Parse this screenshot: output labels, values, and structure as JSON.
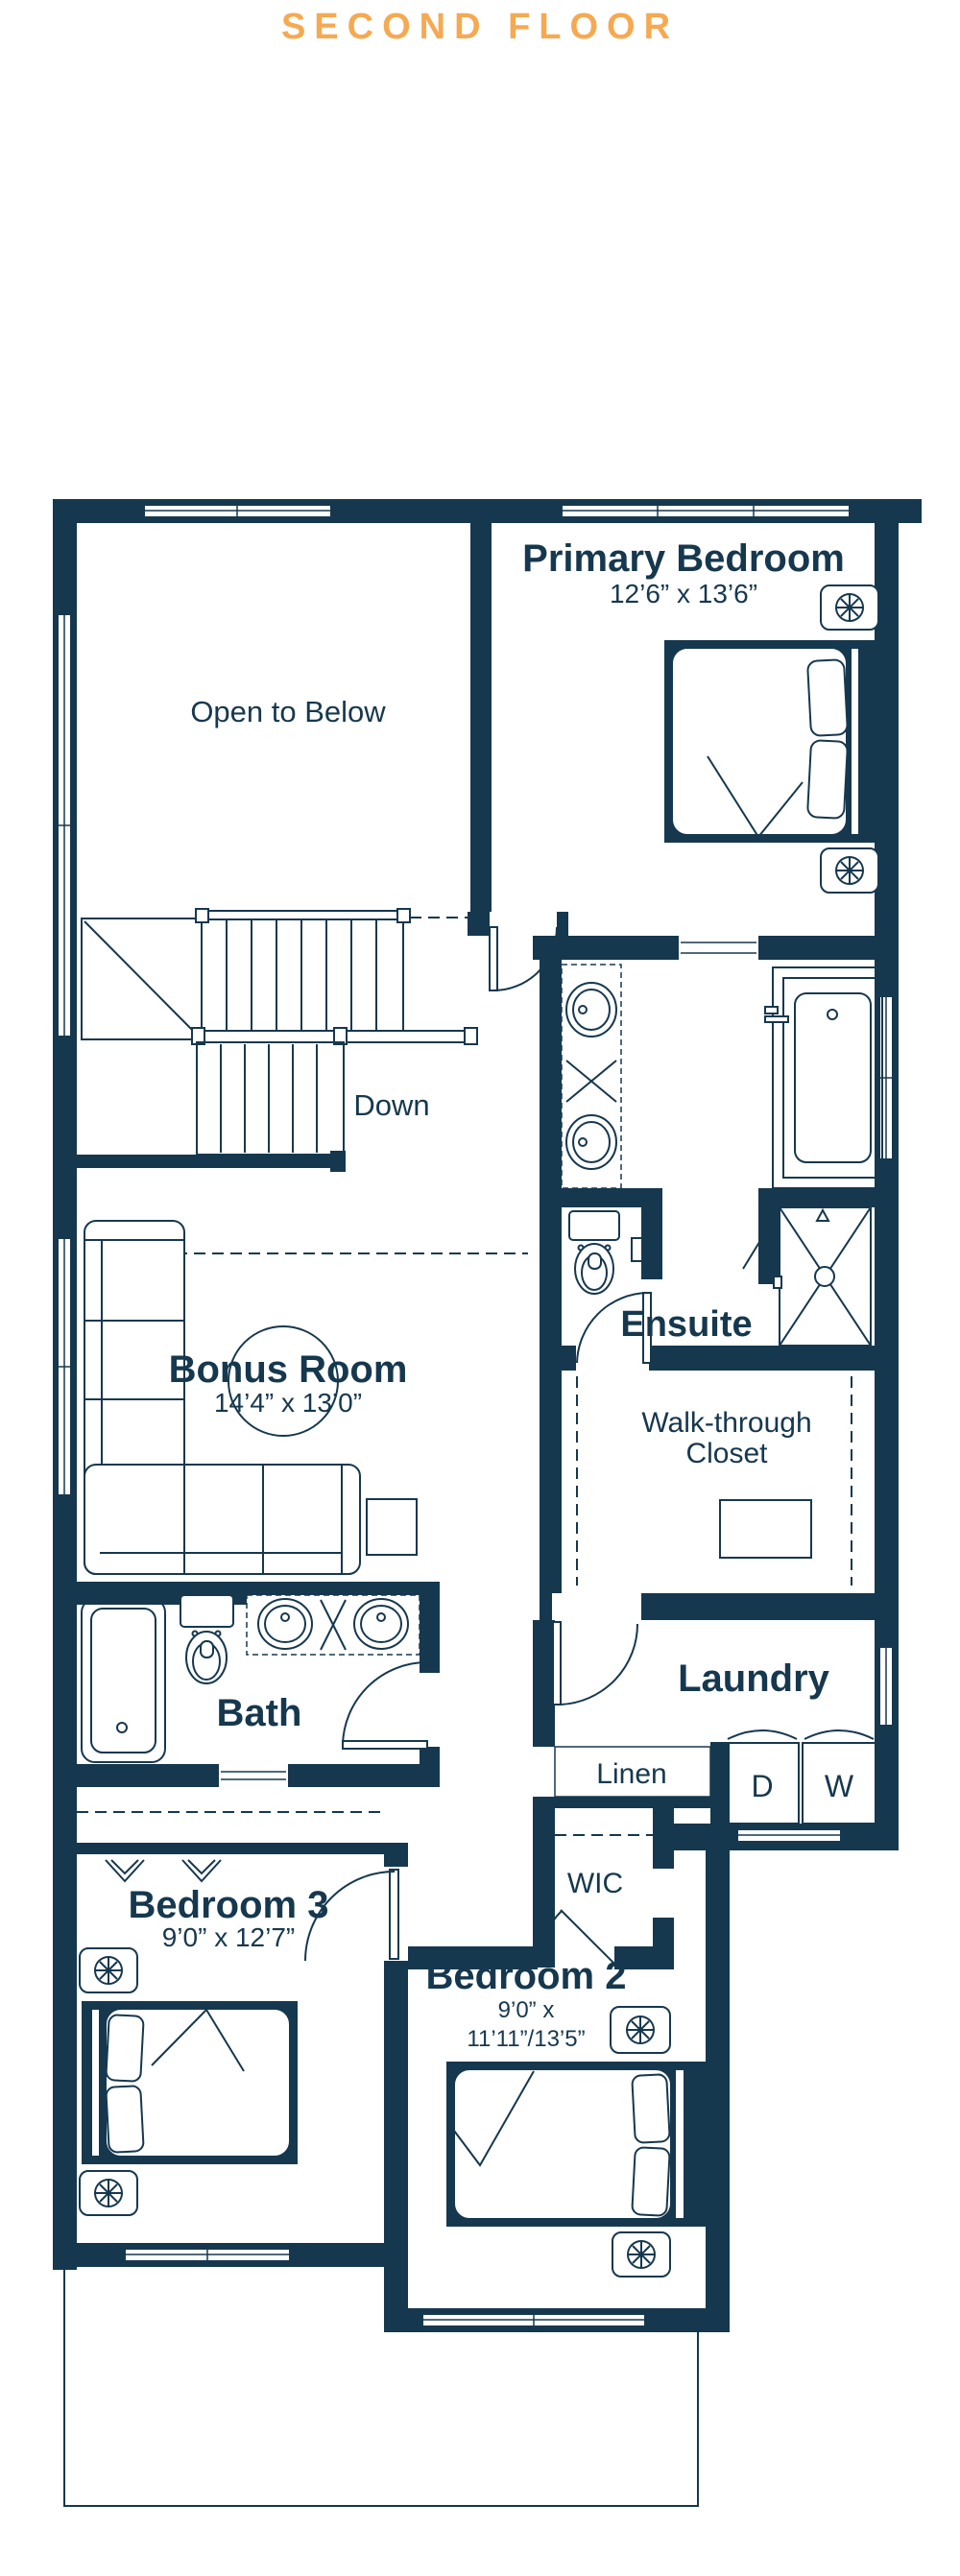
{
  "title": "SECOND FLOOR",
  "colors": {
    "accent": "#F6A951",
    "ink": "#16384E"
  },
  "rooms": {
    "primary_bedroom": {
      "name": "Primary Bedroom",
      "dims": "12’6” x 13’6”"
    },
    "open_to_below": {
      "name": "Open to Below"
    },
    "stairs": {
      "label": "Down"
    },
    "bonus_room": {
      "name": "Bonus Room",
      "dims": "14’4” x 13’0”"
    },
    "ensuite": {
      "name": "Ensuite"
    },
    "walk_through_closet": {
      "line1": "Walk-through",
      "line2": "Closet"
    },
    "bath": {
      "name": "Bath"
    },
    "laundry": {
      "name": "Laundry"
    },
    "linen": {
      "name": "Linen"
    },
    "wic": {
      "name": "WIC"
    },
    "bedroom_3": {
      "name": "Bedroom 3",
      "dims": "9’0” x 12’7”"
    },
    "bedroom_2": {
      "name": "Bedroom 2",
      "dims_line1": "9’0” x",
      "dims_line2": "11’11”/13’5”"
    }
  },
  "appliances": {
    "dryer": "D",
    "washer": "W"
  }
}
